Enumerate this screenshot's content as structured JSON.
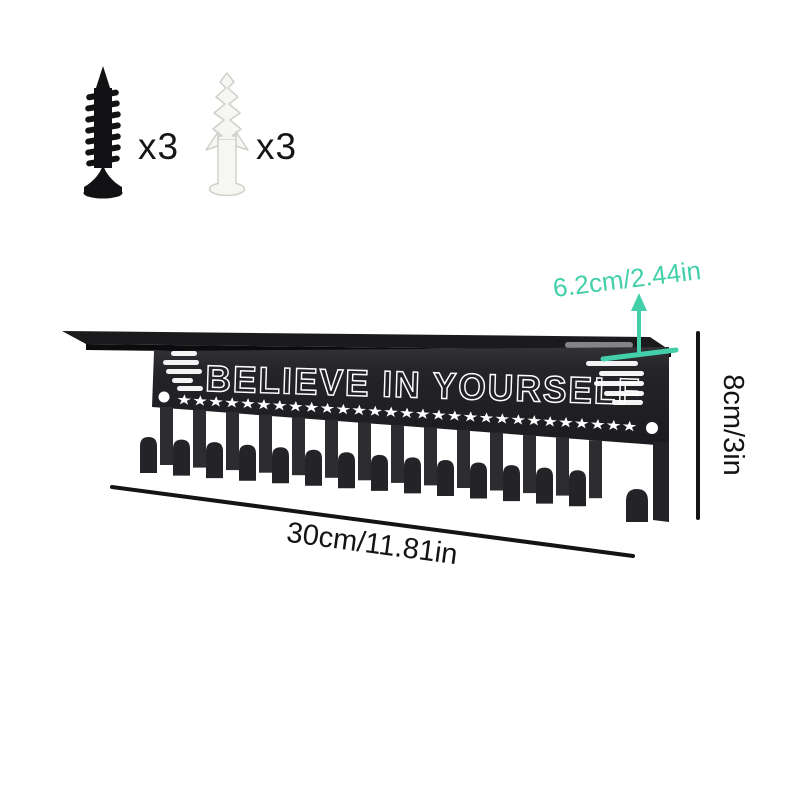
{
  "hardware": {
    "screw": {
      "icon": "screw-icon",
      "count_label": "x3"
    },
    "anchor": {
      "icon": "wall-anchor-icon",
      "count_label": "x3"
    }
  },
  "product": {
    "slogan": "BELIEVE IN YOURSELF",
    "stars": "★★★★★★★★★★★★★★★★★★★★★★★★★★★★★",
    "hook_count": 15,
    "mounting_holes": 2
  },
  "dimensions": {
    "depth": "6.2cm/2.44in",
    "height": "8cm/3in",
    "width": "30cm/11.81in"
  },
  "colors": {
    "accent_teal": "#42cfa9",
    "panel_black": "#232327",
    "annotation_black": "#141414",
    "background": "#ffffff"
  }
}
